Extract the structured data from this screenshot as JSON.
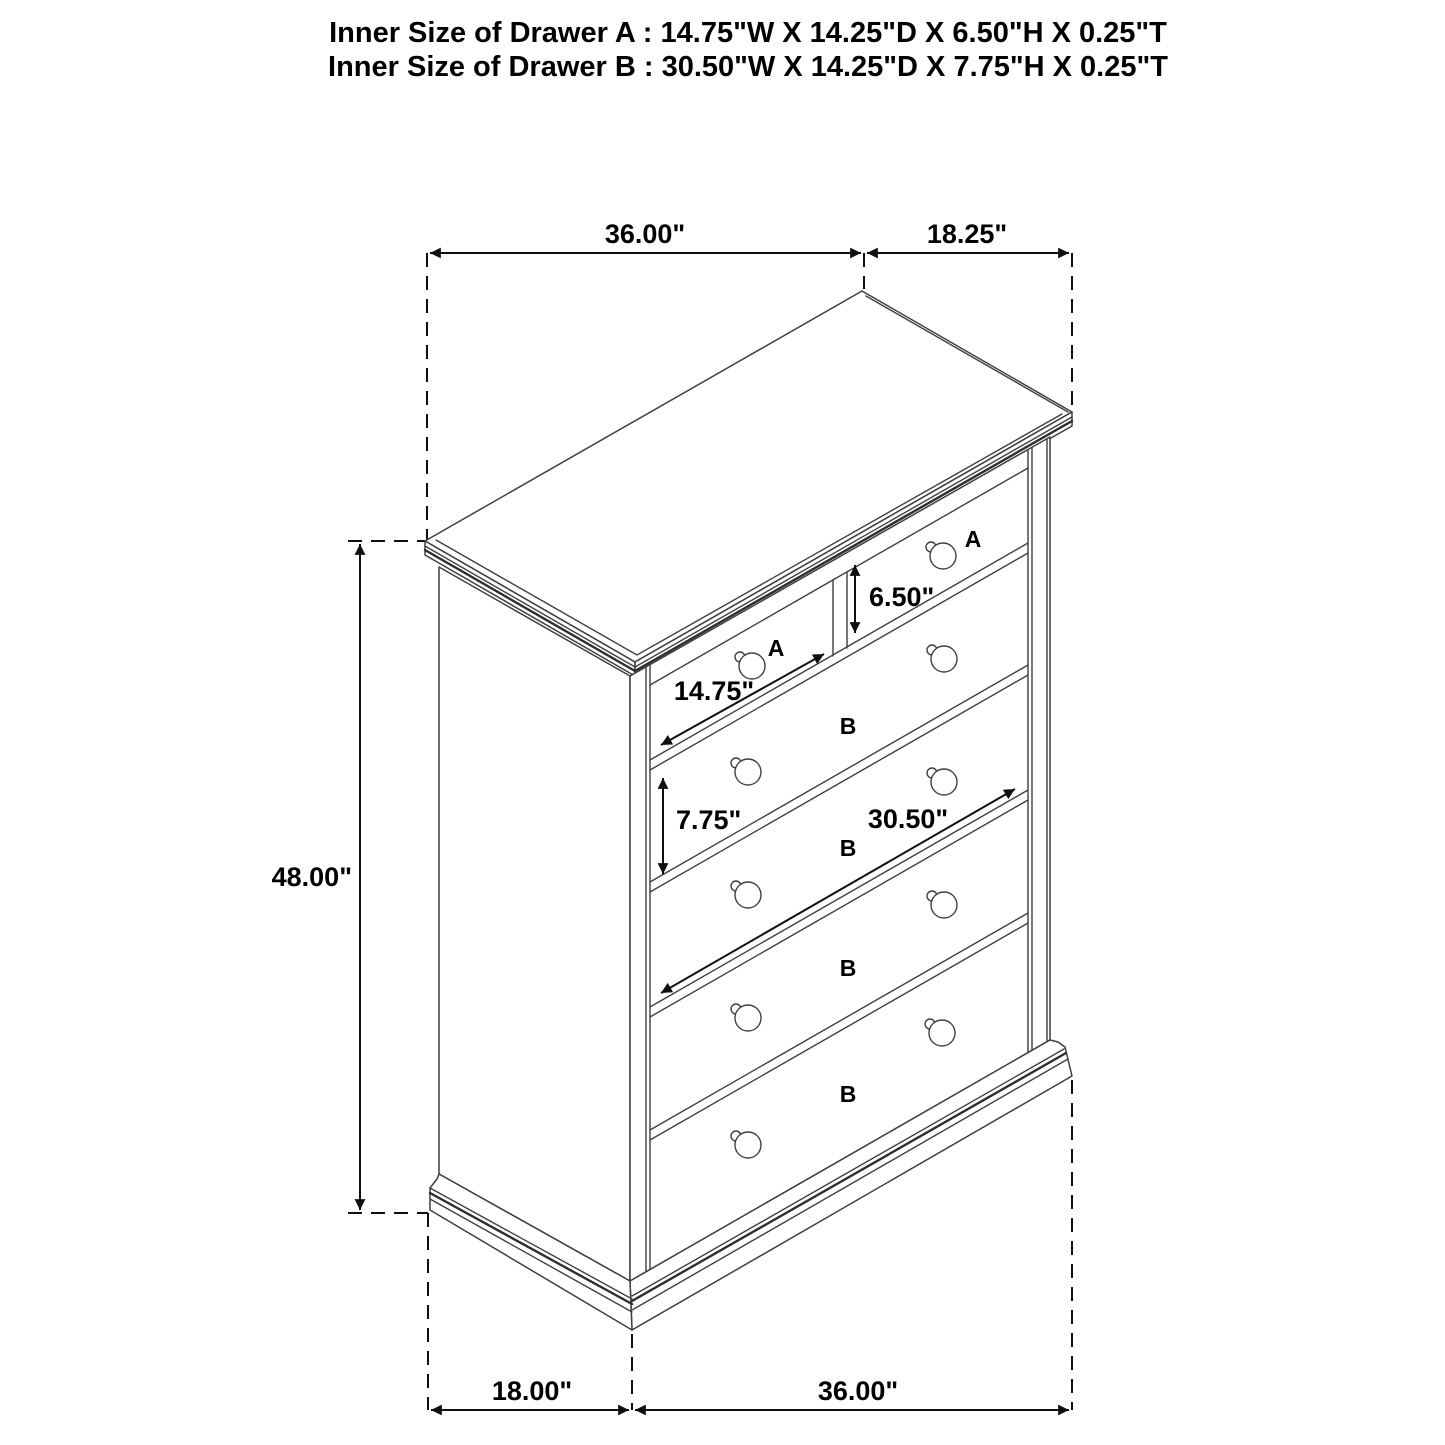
{
  "title": {
    "line1": "Inner Size of Drawer A : 14.75\"W X 14.25\"D X 6.50\"H X 0.25\"T",
    "line2": "Inner Size of Drawer B : 30.50\"W X 14.25\"D X 7.75\"H X 0.25\"T"
  },
  "dimensions": {
    "top_width": "36.00\"",
    "top_depth": "18.25\"",
    "overall_height": "48.00\"",
    "drawer_a_height": "6.50\"",
    "drawer_a_width": "14.75\"",
    "drawer_b_height": "7.75\"",
    "drawer_b_width": "30.50\"",
    "bottom_depth": "18.00\"",
    "bottom_width": "36.00\""
  },
  "drawer_labels": {
    "top_left_a": "A",
    "top_right_a": "A",
    "row2_b": "B",
    "row3_b": "B",
    "row4_b": "B",
    "row5_b": "B"
  },
  "colors": {
    "drawer_letter": "#df1515",
    "dimension_text": "#000000",
    "line_work": "#3f3f3f"
  }
}
